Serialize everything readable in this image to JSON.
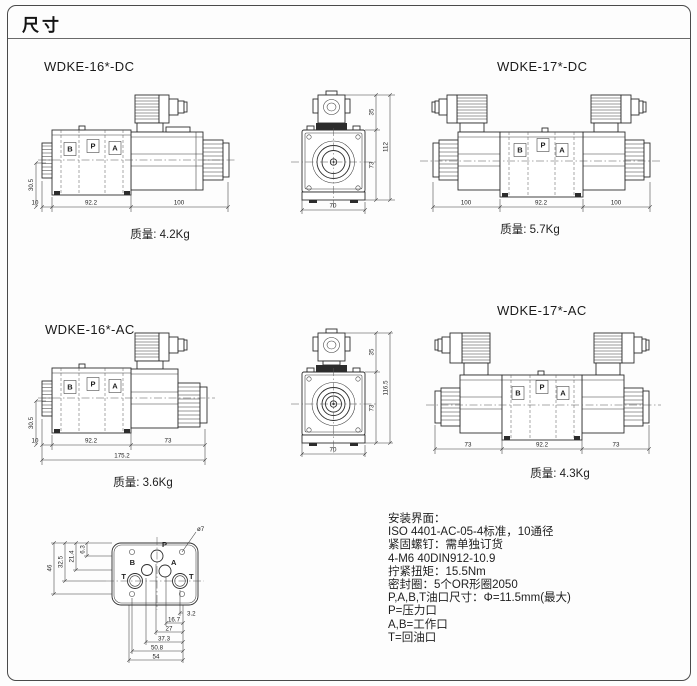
{
  "page": {
    "title": "尺寸"
  },
  "drawings": {
    "d16dc": {
      "title": "WDKE-16*-DC",
      "mass": "质量: 4.2Kg",
      "portB": "B",
      "portP": "P",
      "portA": "A",
      "dimLeft": "30.5",
      "dim1": "10",
      "dim2": "92.2",
      "dim3": "100"
    },
    "frontDC": {
      "dimTop": "35",
      "dimBody": "73",
      "dimTotal": "112",
      "dimWidth": "70"
    },
    "d17dc": {
      "title": "WDKE-17*-DC",
      "mass": "质量: 5.7Kg",
      "portB": "B",
      "portP": "P",
      "portA": "A",
      "dim1": "100",
      "dim2": "92.2",
      "dim3": "100"
    },
    "d16ac": {
      "title": "WDKE-16*-AC",
      "mass": "质量: 3.6Kg",
      "portB": "B",
      "portP": "P",
      "portA": "A",
      "dimLeft": "30.5",
      "dim1": "10",
      "dim2": "92.2",
      "dim3": "73",
      "dimTotal": "175.2"
    },
    "frontAC": {
      "dimTop": "35",
      "dimBody": "73",
      "dimTotal": "116.5",
      "dimWidth": "70"
    },
    "d17ac": {
      "title": "WDKE-17*-AC",
      "mass": "质量: 4.3Kg",
      "portB": "B",
      "portP": "P",
      "portA": "A",
      "dim1": "73",
      "dim2": "92.2",
      "dim3": "73"
    },
    "iface": {
      "callout": "ø7",
      "portP": "P",
      "portA": "A",
      "portB": "B",
      "portT1": "T",
      "portT2": "T",
      "left": {
        "d1": "6.3",
        "d2": "21.4",
        "d3": "32.5",
        "d4": "46"
      },
      "bottom": {
        "d1": "3.2",
        "d2": "16.7",
        "d3": "27",
        "d4": "37.3",
        "d5": "50.8",
        "d6": "54"
      }
    }
  },
  "notes": {
    "lines": [
      "安装界面：",
      "ISO 4401-AC-05-4标准，10通径",
      "紧固螺钉：需单独订货",
      "4-M6 40DIN912-10.9",
      "拧紧扭矩：15.5Nm",
      "密封圈：5个OR形圈2050",
      "P,A,B,T油口尺寸：Φ=11.5mm(最大)",
      "P=压力口",
      "A,B=工作口",
      "T=回油口"
    ]
  }
}
